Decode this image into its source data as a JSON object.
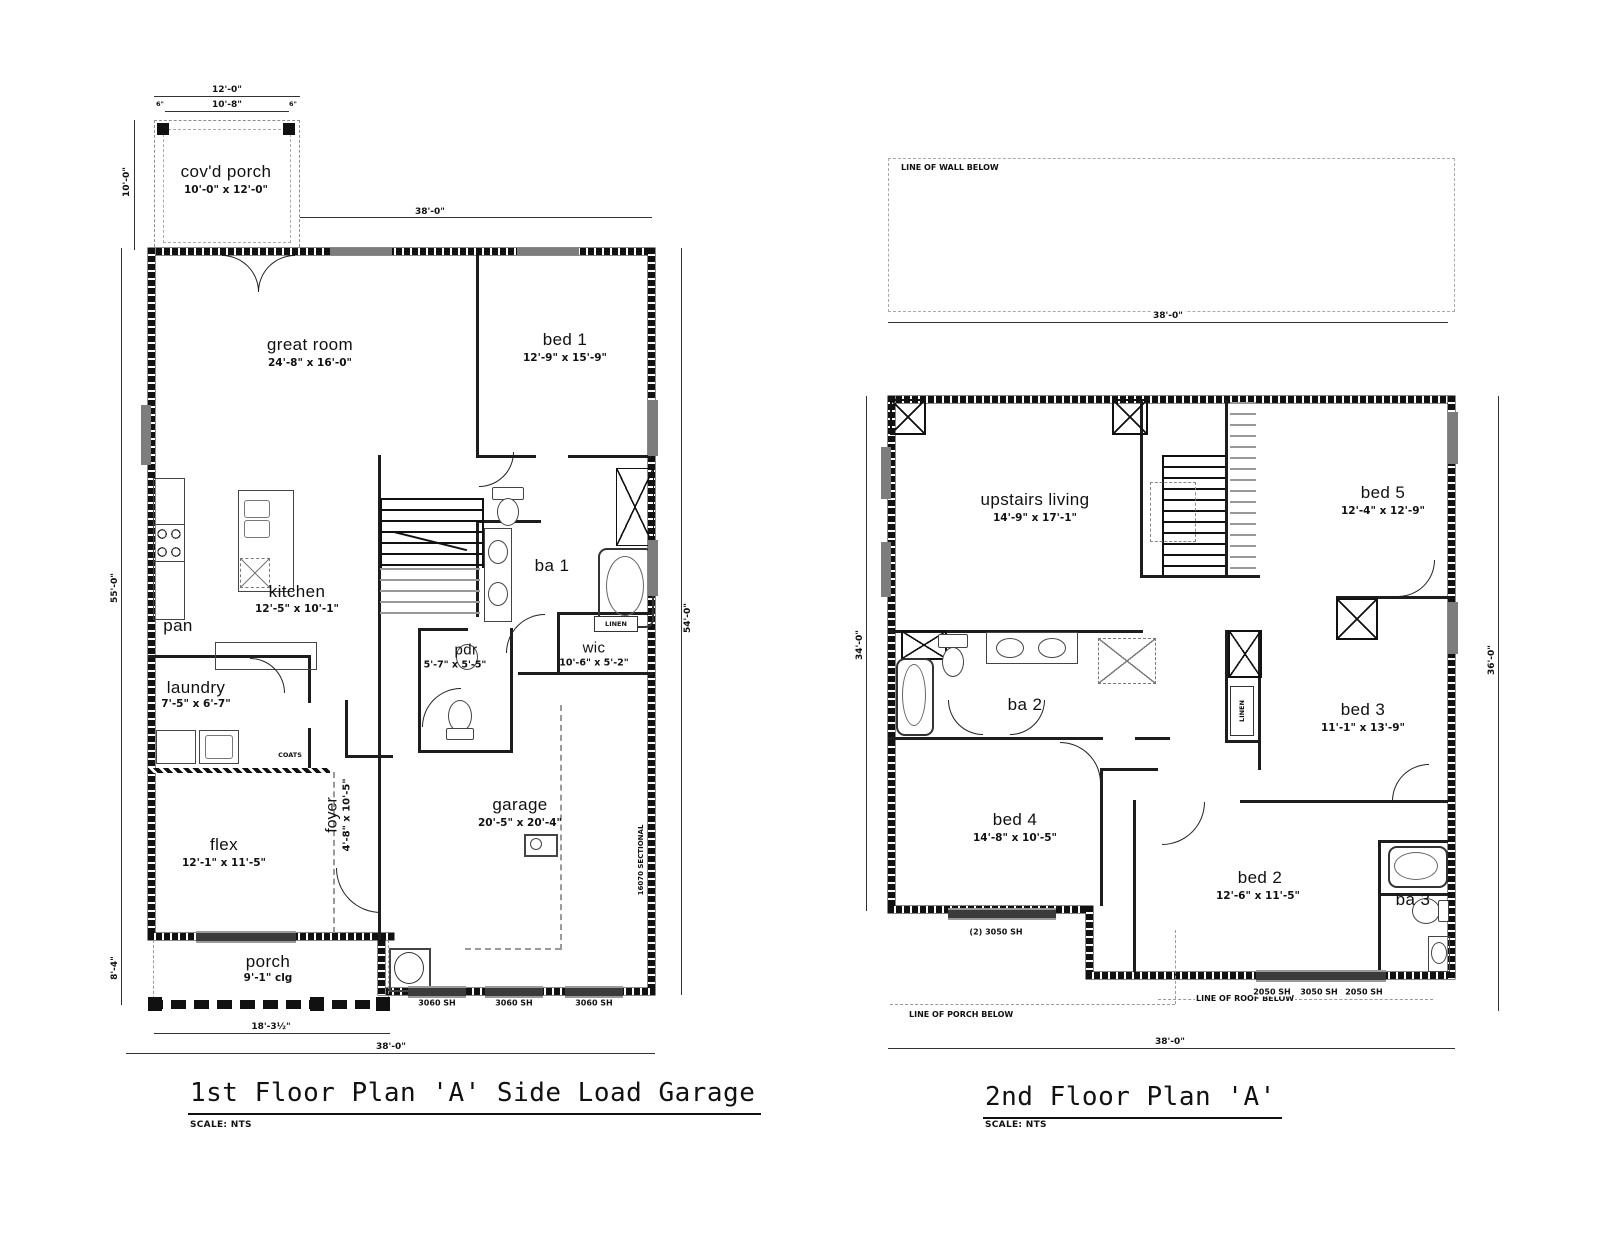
{
  "plan1": {
    "title": "1st Floor Plan 'A' Side Load Garage",
    "scale_label": "SCALE: NTS",
    "rooms": {
      "covd_porch": {
        "name": "cov'd porch",
        "dims": "10'-0\" x 12'-0\""
      },
      "great_room": {
        "name": "great room",
        "dims": "24'-8\" x 16'-0\""
      },
      "bed1": {
        "name": "bed 1",
        "dims": "12'-9\" x 15'-9\""
      },
      "kitchen": {
        "name": "kitchen",
        "dims": "12'-5\" x 10'-1\""
      },
      "pan": {
        "name": "pan"
      },
      "laundry": {
        "name": "laundry",
        "dims": "7'-5\" x 6'-7\""
      },
      "pdr": {
        "name": "pdr",
        "dims": "5'-7\" x 5'-5\""
      },
      "ba1": {
        "name": "ba 1"
      },
      "wic": {
        "name": "wic",
        "dims": "10'-6\" x 5'-2\""
      },
      "flex": {
        "name": "flex",
        "dims": "12'-1\" x 11'-5\""
      },
      "foyer": {
        "name": "foyer",
        "dims": "4'-8\" x 10'-5\""
      },
      "garage": {
        "name": "garage",
        "dims": "20'-5\" x 20'-4\""
      },
      "porch": {
        "name": "porch",
        "dims": "9'-1\" clg"
      }
    },
    "annotations": {
      "coats": "COATS",
      "linen": "LINEN",
      "sectional": "16070 SECTIONAL",
      "window1": "3060 SH",
      "window2": "3060 SH",
      "window3": "3060 SH"
    },
    "dims": {
      "porch_top_outer": "12'-0\"",
      "porch_top_inner": "10'-8\"",
      "tick_left": "6\"",
      "tick_right": "6\"",
      "porch_left": "10'-0\"",
      "top": "38'-0\"",
      "left": "55'-0\"",
      "left_lower": "8'-4\"",
      "right": "54'-0\"",
      "porch_width": "18'-3½\"",
      "overall_bottom": "38'-0\""
    }
  },
  "plan2": {
    "title": "2nd Floor Plan 'A'",
    "scale_label": "SCALE: NTS",
    "rooms": {
      "upstairs_living": {
        "name": "upstairs living",
        "dims": "14'-9\" x 17'-1\""
      },
      "bed5": {
        "name": "bed 5",
        "dims": "12'-4\" x 12'-9\""
      },
      "ba2": {
        "name": "ba 2"
      },
      "bed3": {
        "name": "bed 3",
        "dims": "11'-1\" x 13'-9\""
      },
      "bed4": {
        "name": "bed 4",
        "dims": "14'-8\" x 10'-5\""
      },
      "bed2": {
        "name": "bed 2",
        "dims": "12'-6\" x 11'-5\""
      },
      "ba3": {
        "name": "ba 3"
      }
    },
    "annotations": {
      "wall_below": "LINE OF WALL BELOW",
      "porch_below": "LINE OF PORCH BELOW",
      "roof_below": "LINE OF ROOF BELOW",
      "linen": "LINEN",
      "win_pair": "(2) 3050 SH",
      "win_a": "2050 SH",
      "win_b": "3050 SH",
      "win_c": "2050 SH"
    },
    "dims": {
      "top": "38'-0\"",
      "left": "34'-0\"",
      "right": "36'-0\"",
      "bottom": "38'-0\""
    }
  }
}
